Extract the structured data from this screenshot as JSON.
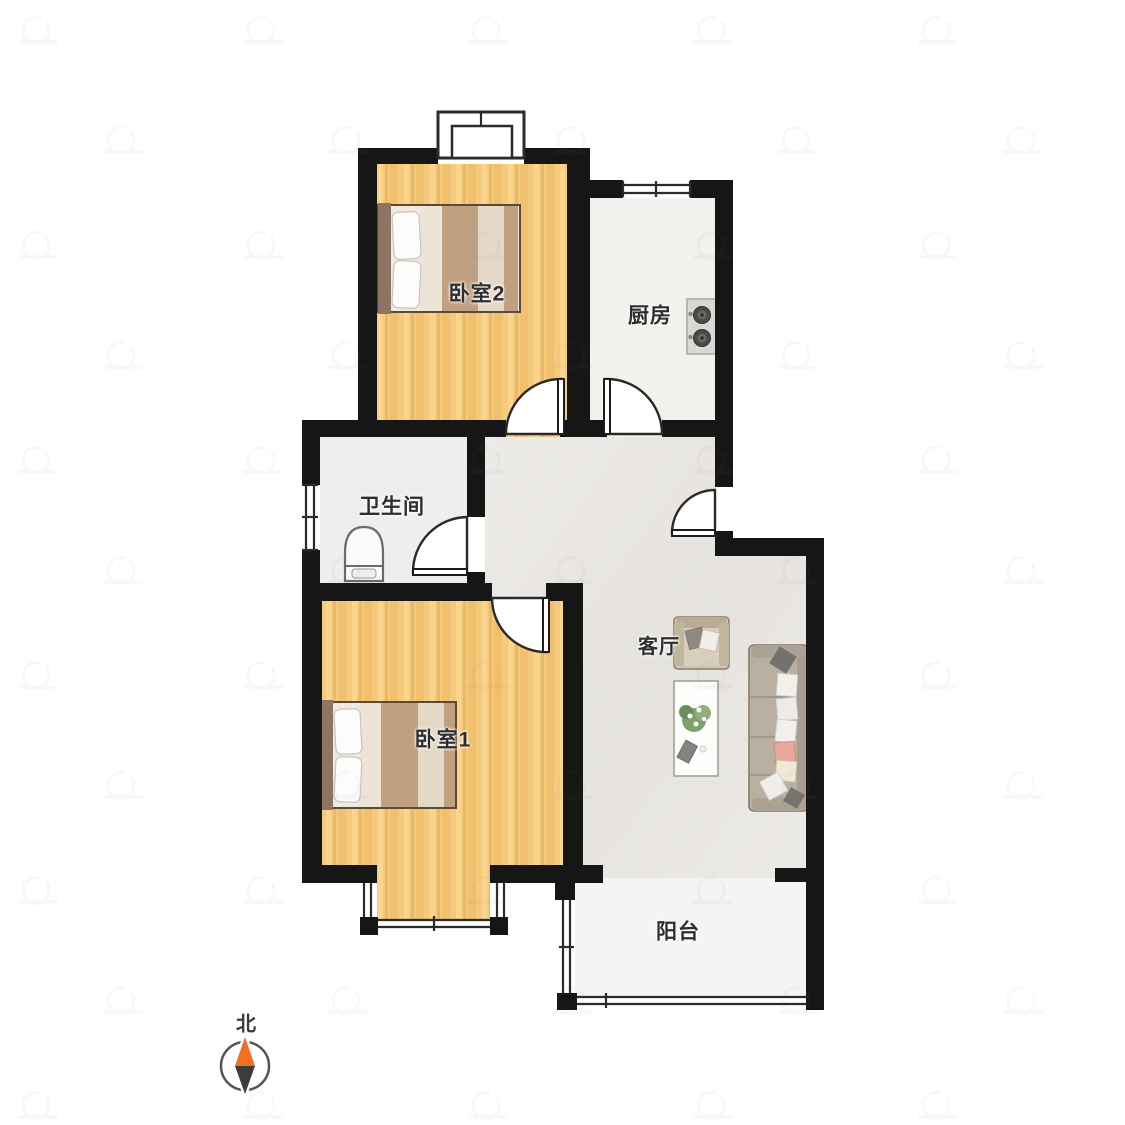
{
  "rooms": {
    "bedroom2": {
      "label": "卧室2"
    },
    "kitchen": {
      "label": "厨房"
    },
    "bathroom": {
      "label": "卫生间"
    },
    "bedroom1": {
      "label": "卧室1"
    },
    "living_room": {
      "label": "客厅"
    },
    "balcony": {
      "label": "阳台"
    }
  },
  "compass": {
    "north_label": "北",
    "north_color": "#f2701f",
    "south_color": "#3d3d3d",
    "ring_color": "#555555"
  },
  "palette": {
    "wall": "#161616",
    "window_line": "#2b2b2b",
    "door_line": "#2a2a2a",
    "bedroom_floor": "#f6ca7c",
    "kitchen_floor": "#f2f1ee",
    "bathroom_floor": "#efeeec",
    "living_floor": "#e9e6e1",
    "balcony_floor": "#f4f4f2",
    "bed_headboard": "#8d7464",
    "blanket_tan": "#bfa182",
    "sofa_body": "#b9b0a2",
    "armchair_body": "#cfc4b0",
    "pillow_pink": "#e8a89c",
    "stove_body": "#d8d8d4",
    "label_color": "#2e2e2e"
  },
  "furniture": {
    "bedroom2": [
      "double-bed"
    ],
    "bedroom1": [
      "double-bed"
    ],
    "bathroom": [
      "toilet"
    ],
    "kitchen": [
      "two-burner-stove"
    ],
    "living_room": [
      "armchair",
      "coffee-table",
      "potted-plant",
      "sofa"
    ]
  }
}
